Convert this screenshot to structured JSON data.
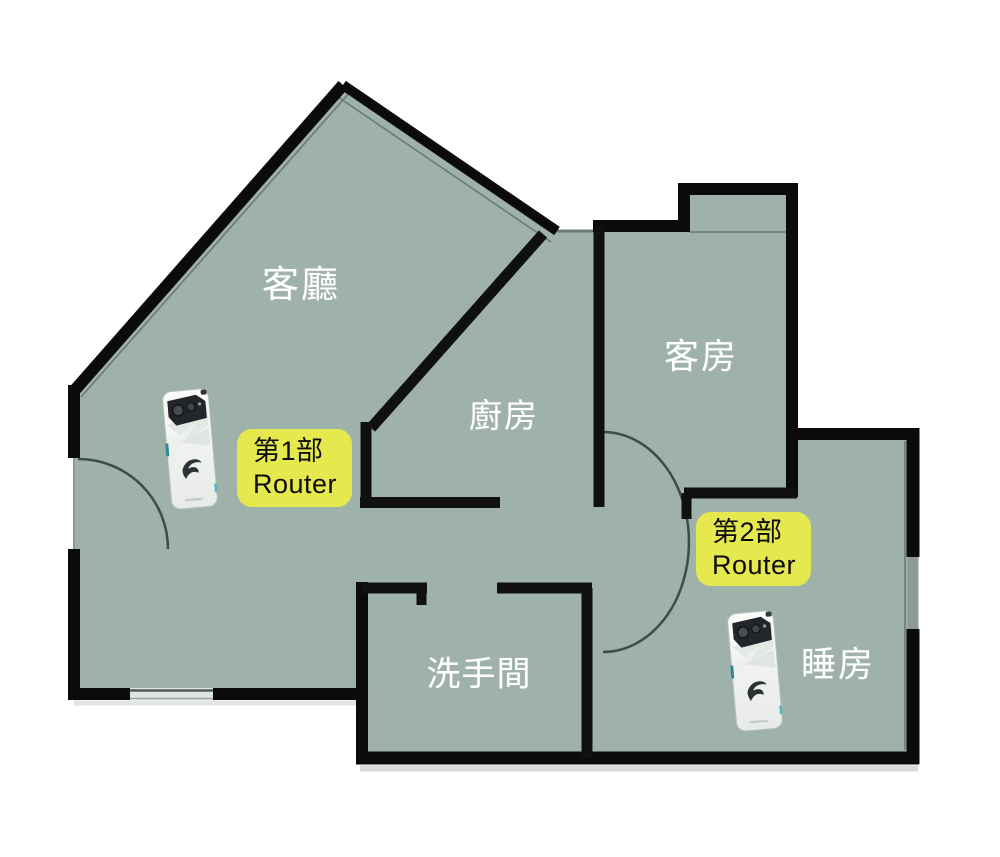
{
  "plan": {
    "type": "apartment-floor-plan",
    "rooms": {
      "living": {
        "label": "客廳"
      },
      "kitchen": {
        "label": "廚房"
      },
      "guest": {
        "label": "客房"
      },
      "bathroom": {
        "label": "洗手間"
      },
      "bedroom": {
        "label": "睡房"
      }
    },
    "annotations": {
      "router1": {
        "line1": "第1部",
        "line2": "Router"
      },
      "router2": {
        "line1": "第2部",
        "line2": "Router"
      }
    },
    "devices": [
      {
        "name": "router-phone-1",
        "location": "living"
      },
      {
        "name": "router-phone-2",
        "location": "bedroom"
      }
    ],
    "colors": {
      "floor": "#9fb2aa",
      "wall": "#0c0c0c",
      "badge": "#e6e94e",
      "room_text": "#ffffff",
      "phone_accent": "#2e8a92",
      "background": "#ffffff"
    }
  }
}
